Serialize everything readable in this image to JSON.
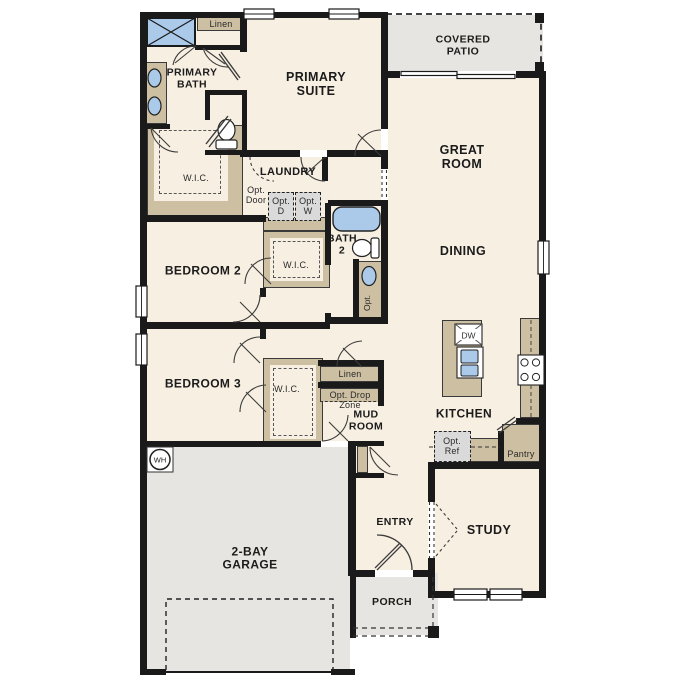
{
  "colors": {
    "floor": "#f7efe2",
    "outdoor": "#e7e5e1",
    "cabinet": "#cdbfa2",
    "fixture": "#abc9e9",
    "wall": "#1a1a1a",
    "optional": "#dadada",
    "line": "#3c3c3c"
  },
  "labels": {
    "covered_patio": "COVERED\nPATIO",
    "primary_suite": "PRIMARY\nSUITE",
    "primary_bath": "PRIMARY\nBATH",
    "linen_top": "Linen",
    "wic_primary": "W.I.C.",
    "laundry": "LAUNDRY",
    "opt_door": "Opt.\nDoor",
    "opt_dryer": "Opt.\nD",
    "opt_washer": "Opt.\nW",
    "great_room": "GREAT\nROOM",
    "dining": "DINING",
    "bath_2": "BATH\n2",
    "bath2_opt": "Opt.",
    "bedroom_2": "BEDROOM 2",
    "wic_2": "W.I.C.",
    "bedroom_3": "BEDROOM 3",
    "wic_3": "W.I.C.",
    "linen_hall": "Linen",
    "opt_drop_zone": "Opt. Drop\nZone",
    "mud_room": "MUD\nROOM",
    "kitchen": "KITCHEN",
    "dishwasher": "DW",
    "opt_ref": "Opt.\nRef",
    "pantry": "Pantry",
    "garage": "2-BAY\nGARAGE",
    "entry": "ENTRY",
    "porch": "PORCH",
    "study": "STUDY",
    "water_heater": "WH"
  }
}
